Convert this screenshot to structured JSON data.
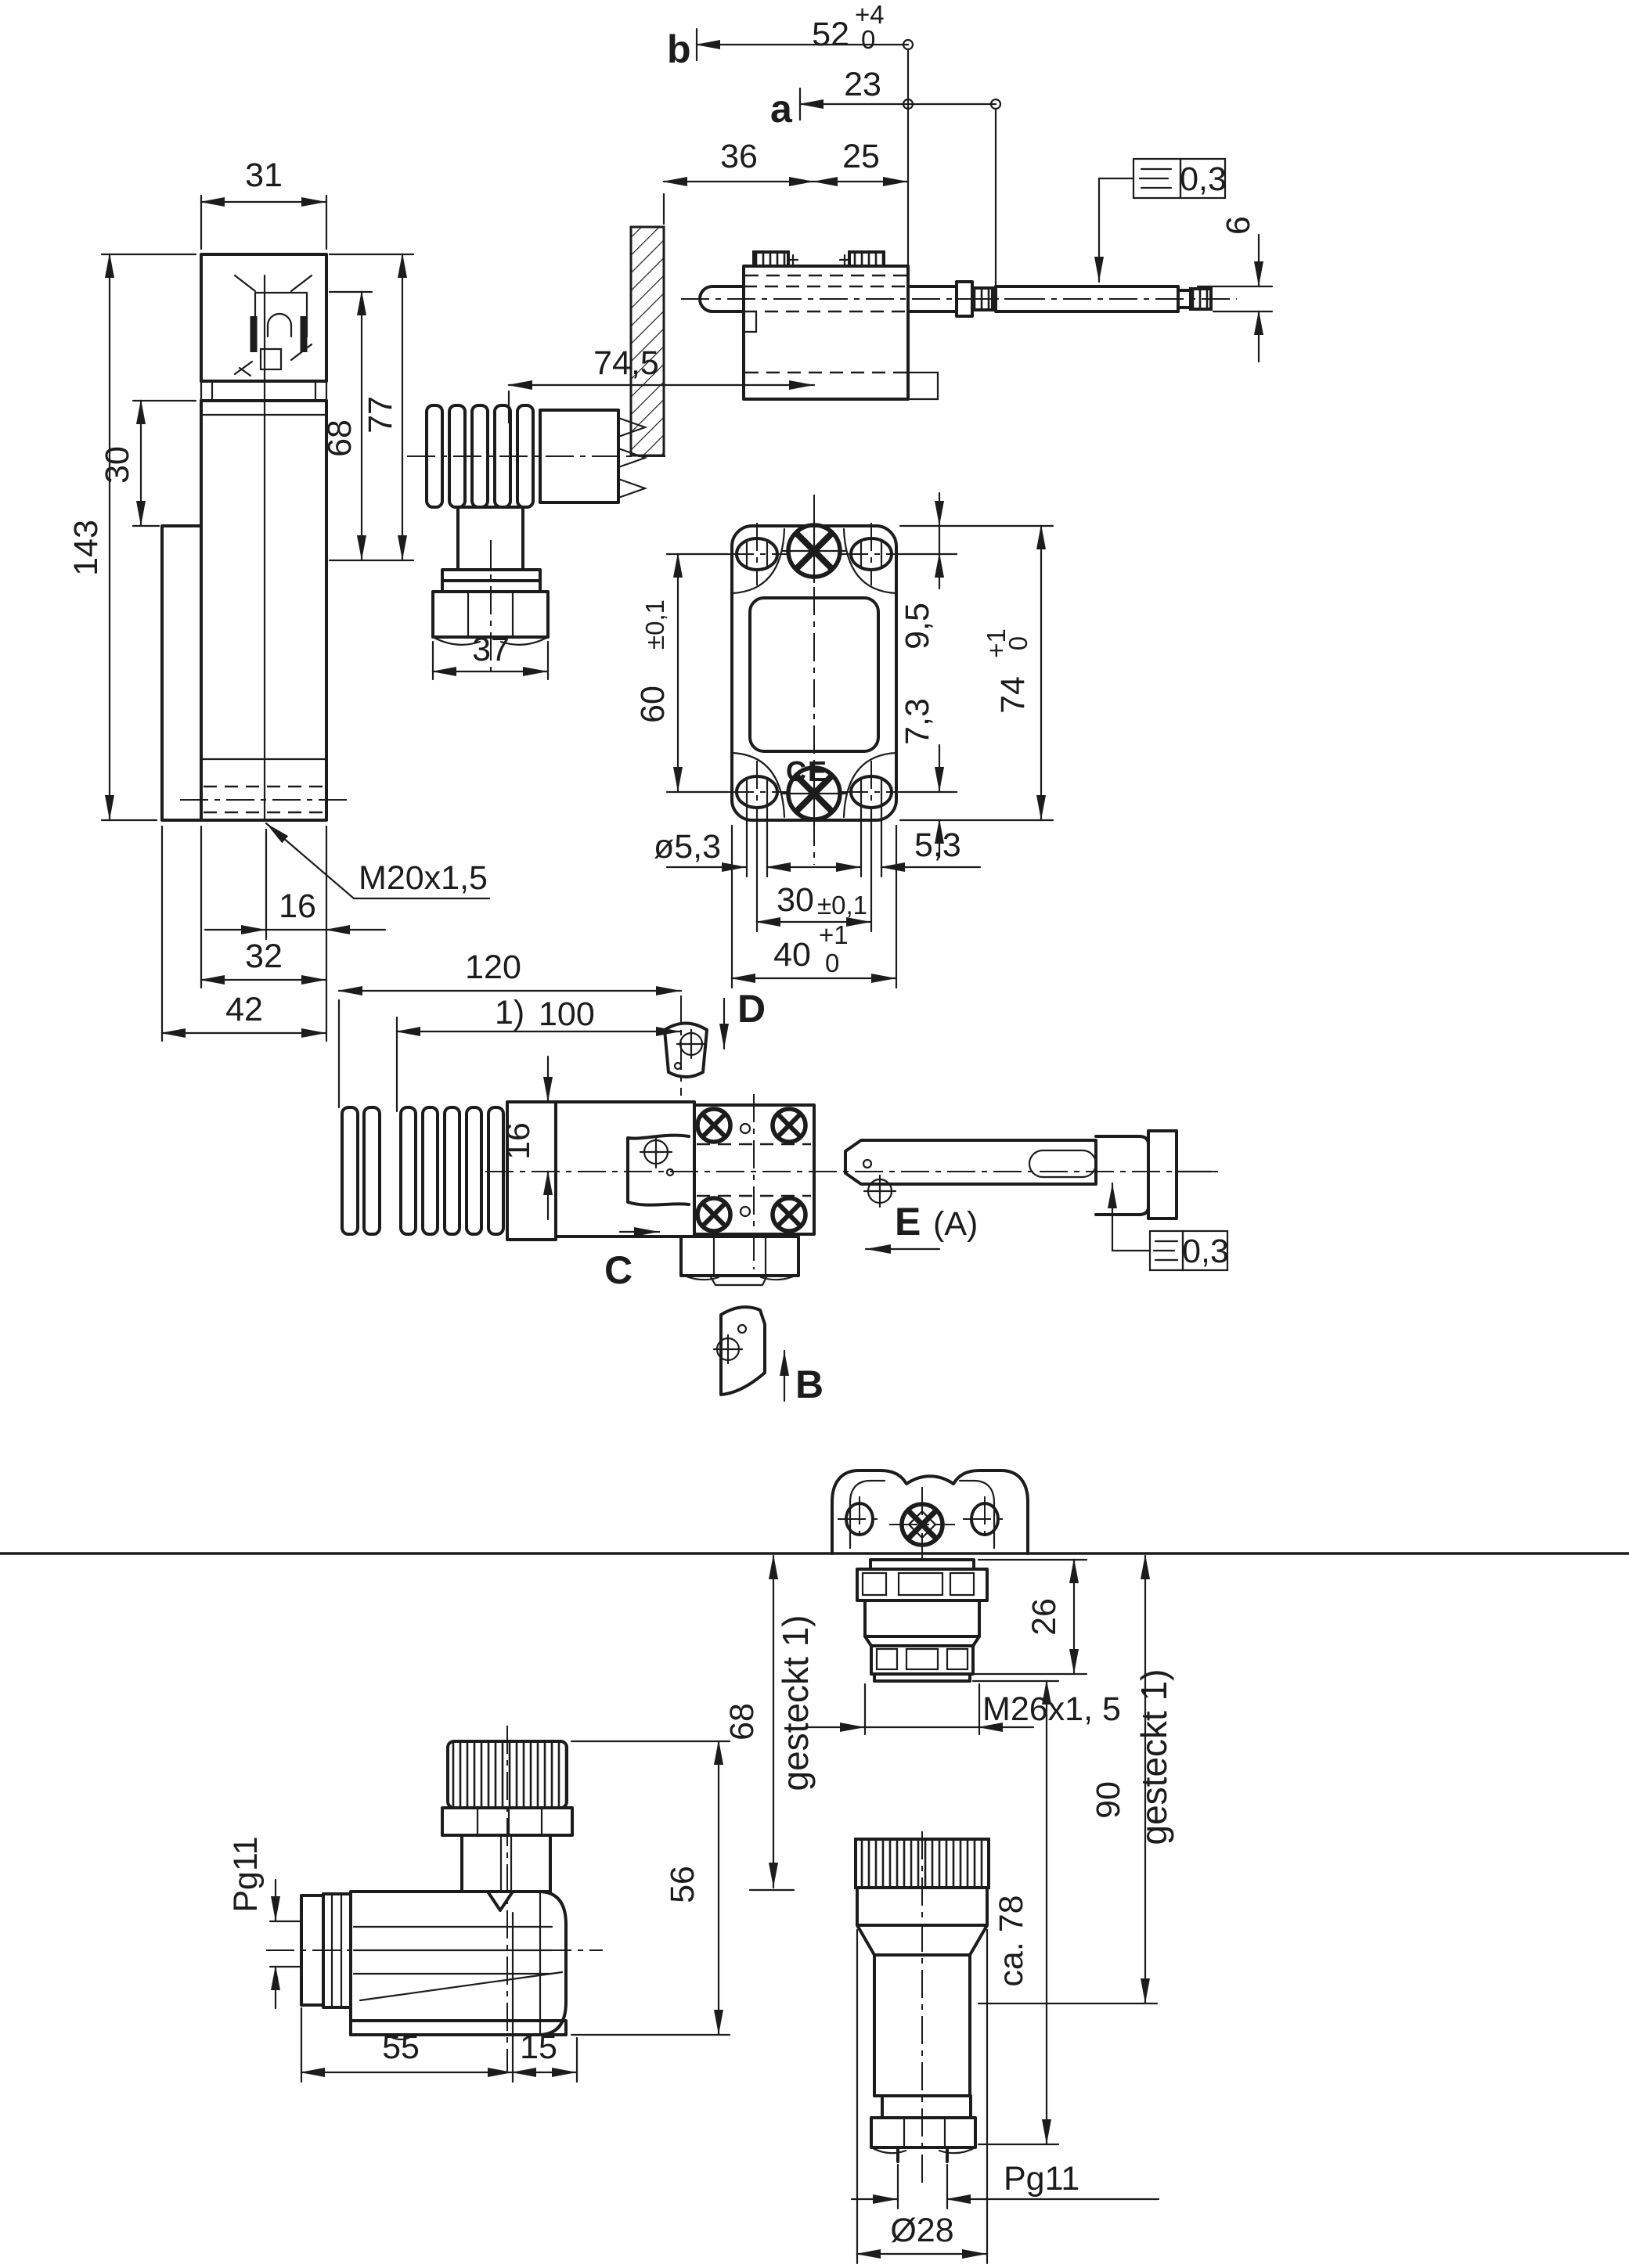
{
  "drawing_type": "technical dimensional drawing (limit switch with connectors)",
  "colors": {
    "ink": "#1c1c1c",
    "bg": "#ffffff"
  },
  "labels": {
    "b": "b",
    "a": "a",
    "C": "C",
    "D": "D",
    "E": "E",
    "A_ref": "(A)",
    "B": "B",
    "d52": "52",
    "tp4": "+4",
    "t0": "0",
    "d23": "23",
    "d36": "36",
    "d25": "25",
    "d745": "74,5",
    "d37": "37",
    "d31": "31",
    "d143": "143",
    "d30": "30",
    "d68": "68",
    "d77": "77",
    "m20": "M20x1,5",
    "d16": "16",
    "d32": "32",
    "d42": "42",
    "d60": "60",
    "pm": "±0,1",
    "d95": "9,5",
    "d73": "7,3",
    "d74": "74",
    "tp1": "+1",
    "dia53": "ø5,3",
    "d53": "5,3",
    "d40": "40",
    "tol": "0,3",
    "d6": "6",
    "d120": "120",
    "note1": "1)",
    "d100": "100",
    "pg11": "Pg11",
    "d55": "55",
    "d15": "15",
    "d56": "56",
    "gesteckt": "gesteckt  1)",
    "d26": "26",
    "m26": "M26x1, 5",
    "d90": "90",
    "ca78": "ca. 78",
    "dia28": "Ø28",
    "ce": "CE"
  }
}
